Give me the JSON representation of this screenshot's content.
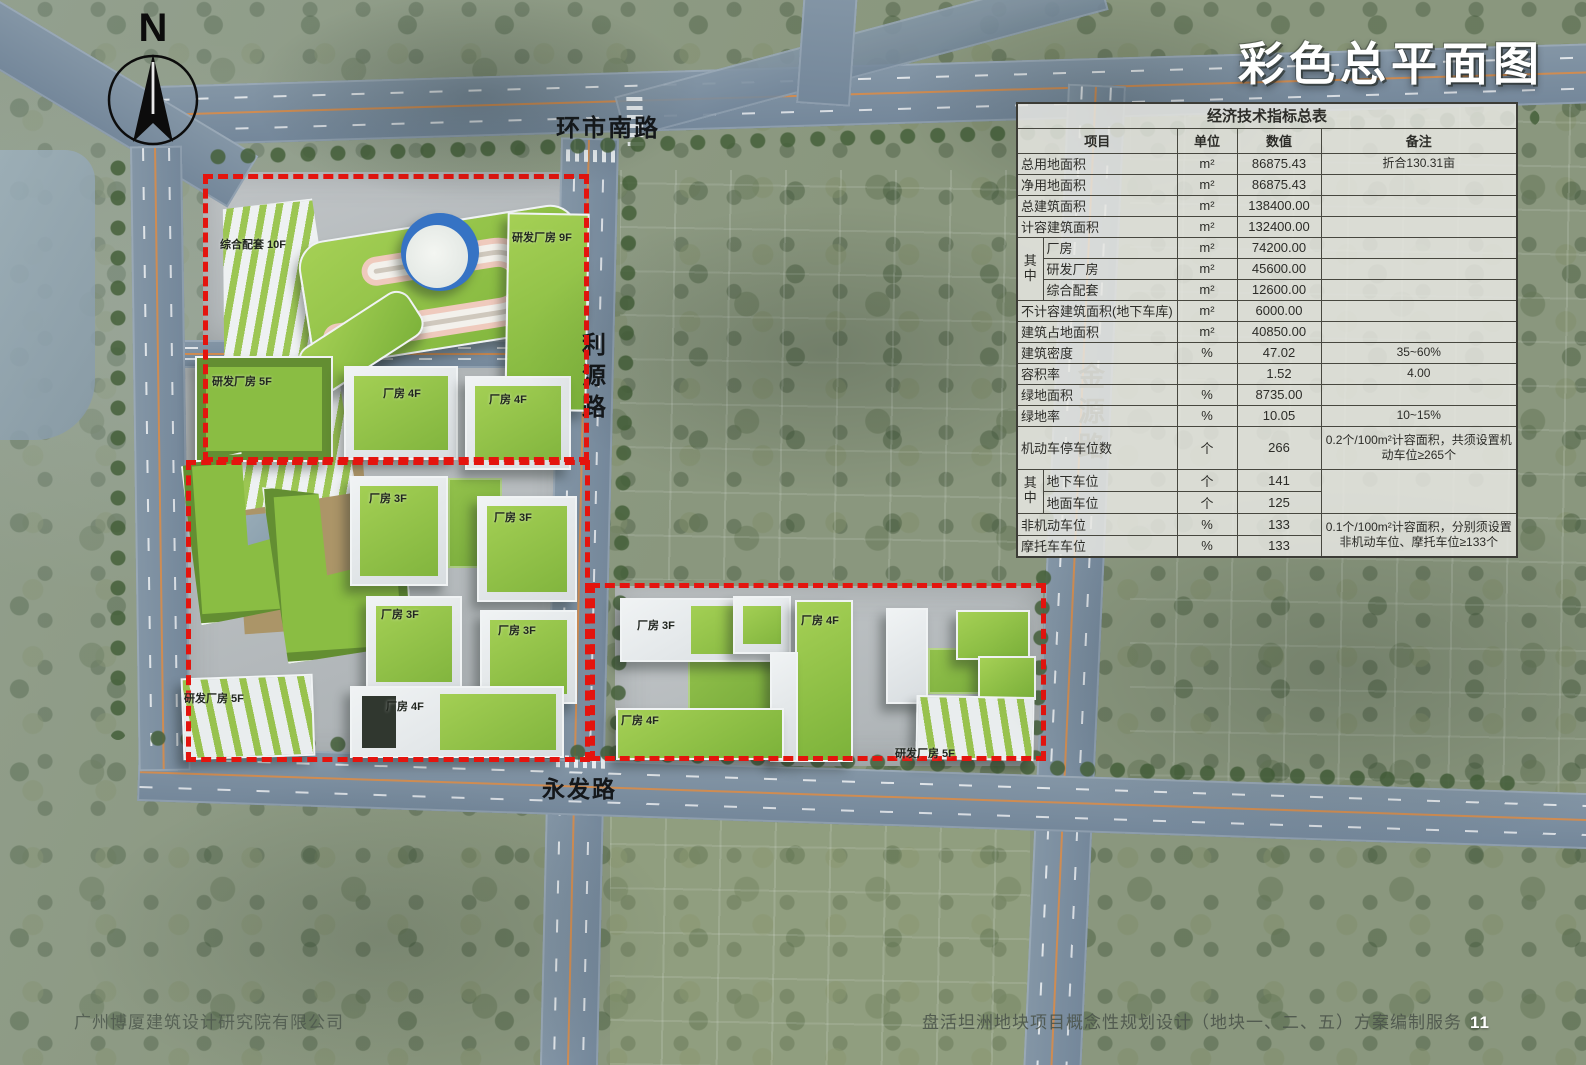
{
  "page": {
    "title": "彩色总平面图",
    "footer_left": "广州博厦建筑设计研究院有限公司",
    "footer_right": "盘活坦洲地块项目概念性规划设计（地块一、二、五）方案编制服务",
    "page_number": "11"
  },
  "compass": {
    "north_label": "N"
  },
  "road_labels": {
    "north": "环市南路",
    "liyuan": "利源路",
    "yongfa": "永发路",
    "jinyuan": "金源路"
  },
  "building_labels": [
    "综合配套 10F",
    "研发厂房 9F",
    "研发厂房 5F",
    "厂房 4F",
    "厂房 4F",
    "厂房 3F",
    "厂房 3F",
    "厂房 3F",
    "厂房 3F",
    "研发厂房 5F",
    "厂房 4F",
    "厂房 3F",
    "厂房 4F",
    "厂房 4F",
    "研发厂房 5F"
  ],
  "colors": {
    "boundary_red": "#e4140e",
    "roof_green": "#8fc045",
    "road_blue_gray": "#7b8c9c",
    "dome_blue": "#3673c4"
  },
  "indicator_table": {
    "title": "经济技术指标总表",
    "headers": {
      "item": "项目",
      "unit": "单位",
      "value": "数值",
      "remark": "备注"
    },
    "group_label": "其中",
    "rows": [
      {
        "item": "总用地面积",
        "unit": "m²",
        "value": "86875.43",
        "remark": "折合130.31亩"
      },
      {
        "item": "净用地面积",
        "unit": "m²",
        "value": "86875.43",
        "remark": ""
      },
      {
        "item": "总建筑面积",
        "unit": "m²",
        "value": "138400.00",
        "remark": ""
      },
      {
        "item": "计容建筑面积",
        "unit": "m²",
        "value": "132400.00",
        "remark": ""
      },
      {
        "item": "厂房",
        "unit": "m²",
        "value": "74200.00",
        "remark": ""
      },
      {
        "item": "研发厂房",
        "unit": "m²",
        "value": "45600.00",
        "remark": ""
      },
      {
        "item": "综合配套",
        "unit": "m²",
        "value": "12600.00",
        "remark": ""
      },
      {
        "item": "不计容建筑面积(地下车库)",
        "unit": "m²",
        "value": "6000.00",
        "remark": ""
      },
      {
        "item": "建筑占地面积",
        "unit": "m²",
        "value": "40850.00",
        "remark": ""
      },
      {
        "item": "建筑密度",
        "unit": "%",
        "value": "47.02",
        "remark": "35~60%"
      },
      {
        "item": "容积率",
        "unit": "",
        "value": "1.52",
        "remark": "4.00"
      },
      {
        "item": "绿地面积",
        "unit": "%",
        "value": "8735.00",
        "remark": ""
      },
      {
        "item": "绿地率",
        "unit": "%",
        "value": "10.05",
        "remark": "10~15%"
      },
      {
        "item": "机动车停车位数",
        "unit": "个",
        "value": "266",
        "remark": "0.2个/100m²计容面积，共须设置机动车位≥265个"
      },
      {
        "item": "地下车位",
        "unit": "个",
        "value": "141",
        "remark": ""
      },
      {
        "item": "地面车位",
        "unit": "个",
        "value": "125",
        "remark": ""
      },
      {
        "item": "非机动车位",
        "unit": "%",
        "value": "133",
        "remark": "0.1个/100m²计容面积，分别须设置非机动车位、摩托车位≥133个"
      },
      {
        "item": "摩托车车位",
        "unit": "%",
        "value": "133",
        "remark": ""
      }
    ]
  }
}
